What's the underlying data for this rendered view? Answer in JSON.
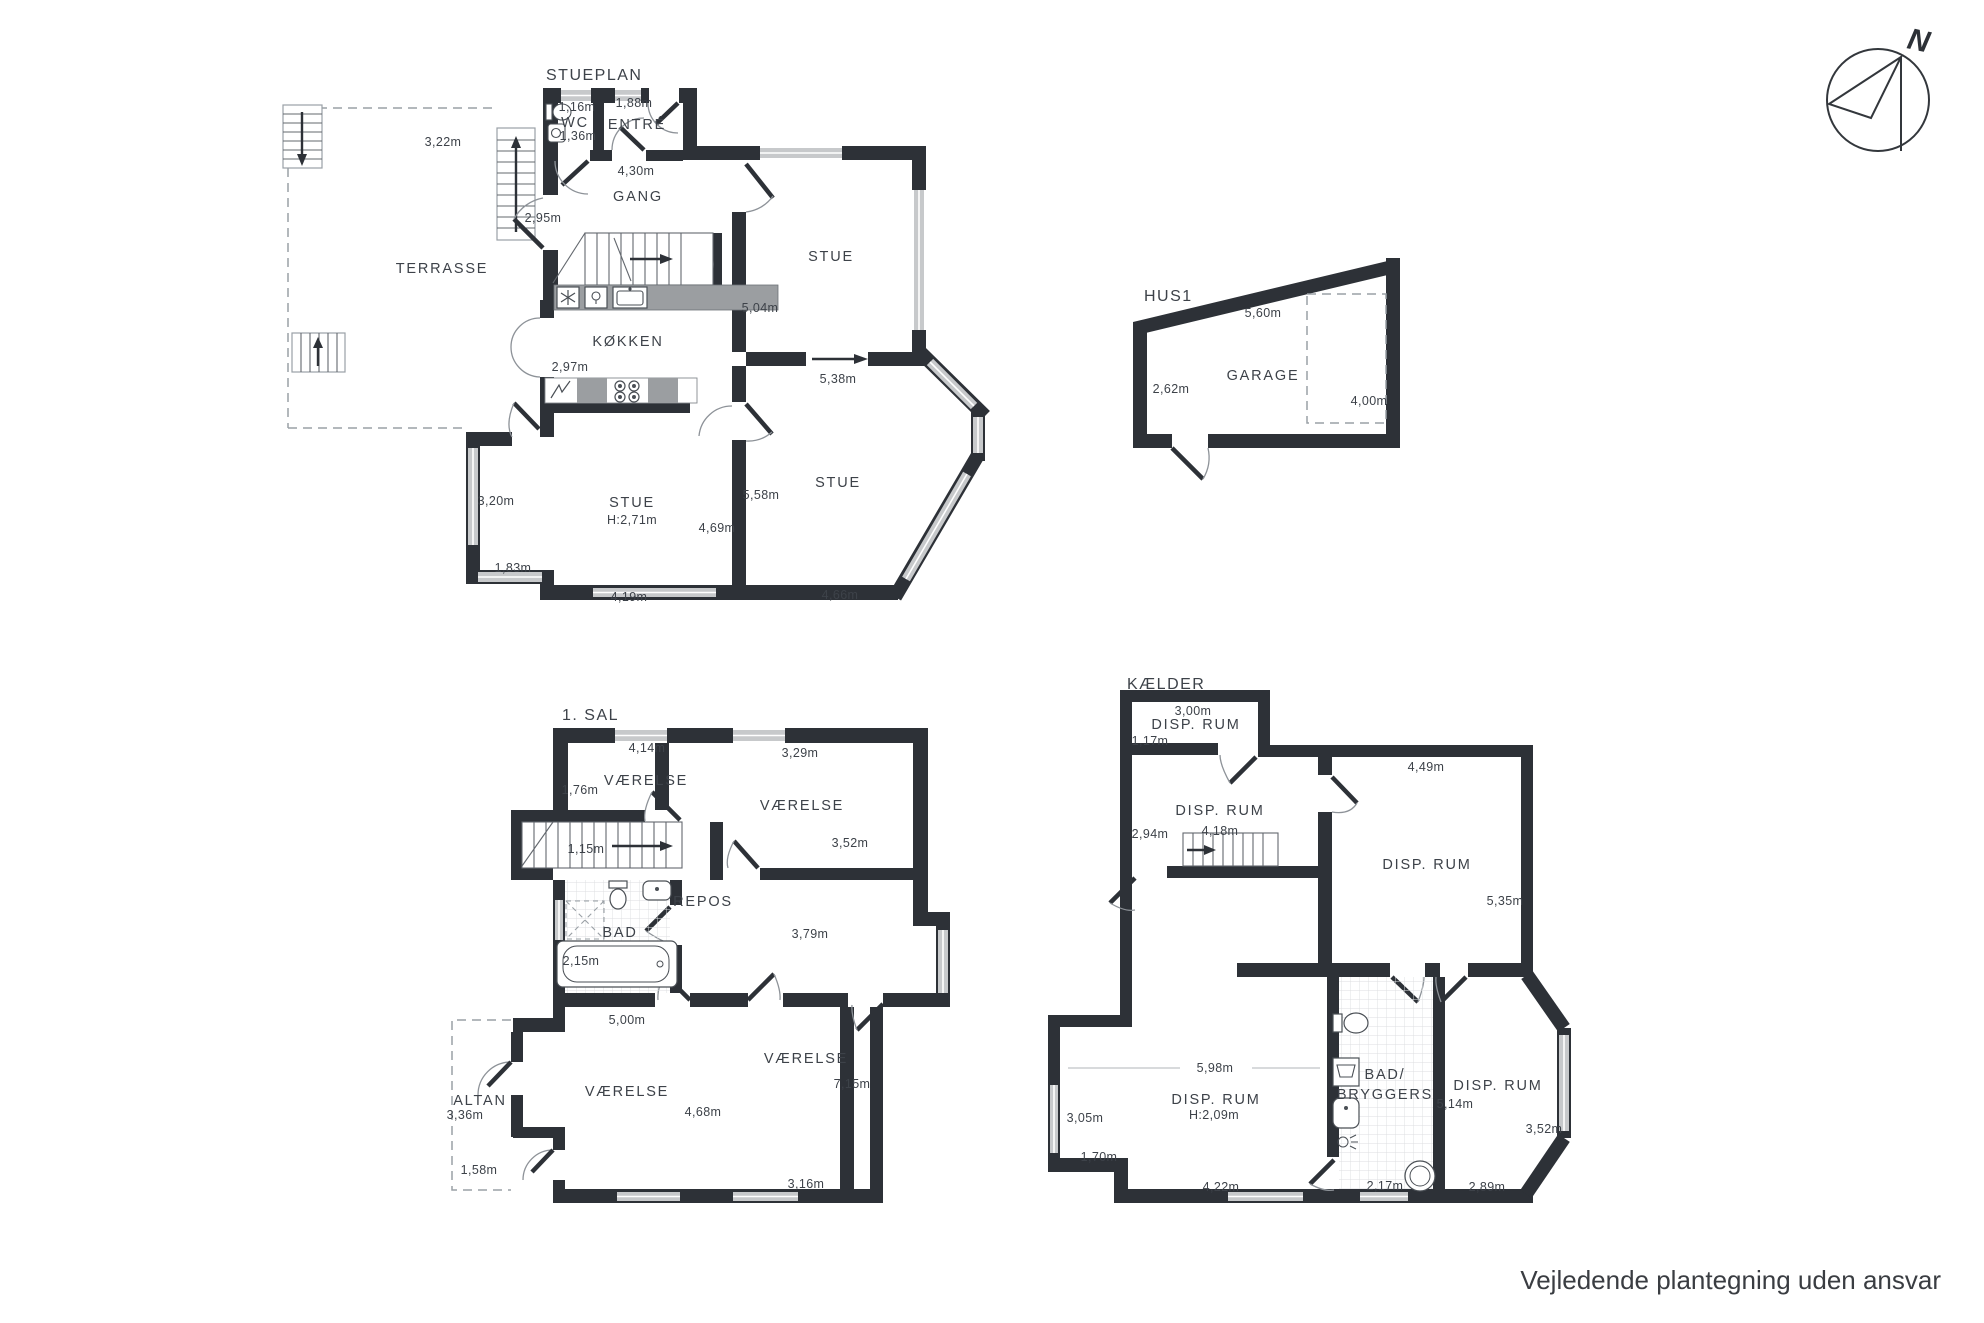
{
  "page": {
    "footer_note": "Vejledende plantegning uden ansvar"
  },
  "compass": {
    "north": "N"
  },
  "stueplan": {
    "title": "STUEPLAN",
    "rooms": {
      "terrasse": "TERRASSE",
      "wc": "WC",
      "entre": "ENTRÉ",
      "gang": "GANG",
      "kokken": "KØKKEN",
      "stue_top_right": "STUE",
      "stue_bottom_right": "STUE",
      "stue_bottom_left": "STUE",
      "stue_bottom_left_height": "H:2,71m"
    },
    "dims": {
      "wc_width": "1,16m",
      "wc_depth": "1,36m",
      "entre_width": "1,88m",
      "gang_width": "4,30m",
      "gang_side": "2,95m",
      "terrasse_width": "3,22m",
      "stue_tr_depth": "5,04m",
      "kokken_side": "2,97m",
      "stue_tr_width": "5,38m",
      "stue_bl_window": "3,20m",
      "stue_br_depth": "5,58m",
      "stue_bl_depth": "4,69m",
      "stue_bl_window2": "1,83m",
      "stue_bl_width": "4,19m",
      "stue_br_width": "4,66m"
    }
  },
  "hus1": {
    "title": "HUS1",
    "rooms": {
      "garage": "GARAGE"
    },
    "dims": {
      "top": "5,60m",
      "left": "2,62m",
      "right": "4,00m"
    }
  },
  "sal1": {
    "title": "1. SAL",
    "rooms": {
      "vaerelse_tl": "VÆRELSE",
      "vaerelse_tr": "VÆRELSE",
      "vaerelse_bl": "VÆRELSE",
      "vaerelse_br": "VÆRELSE",
      "bad": "BAD",
      "repos": "REPOS",
      "altan": "ALTAN"
    },
    "dims": {
      "tl_width": "4,14m",
      "tl_side": "1,76m",
      "tr_width": "3,29m",
      "tr_depth": "3,52m",
      "stairs": "1,15m",
      "bad_width": "2,15m",
      "mid_depth": "3,79m",
      "bl_width": "5,00m",
      "bl_depth": "4,68m",
      "br_depth": "7,15m",
      "br_width": "3,16m",
      "altan_width": "3,36m",
      "altan_side": "1,58m"
    }
  },
  "kaelder": {
    "title": "KÆLDER",
    "rooms": {
      "disp_tl": "DISP. RUM",
      "disp_mid": "DISP. RUM",
      "disp_right": "DISP. RUM",
      "disp_bl": "DISP. RUM",
      "disp_bl_height": "H:2,09m",
      "disp_br": "DISP. RUM",
      "bad_line1": "BAD/",
      "bad_line2": "BRYGGERS"
    },
    "dims": {
      "tl_width": "3,00m",
      "tl_side": "1,17m",
      "right_width": "4,49m",
      "mid_side": "2,94m",
      "stairs": "4,18m",
      "right_depth": "5,35m",
      "bl_width": "5,98m",
      "bl_window": "3,05m",
      "bl_window2": "1,70m",
      "bl_width2": "4,22m",
      "bad_width": "2,17m",
      "br_depth": "5,14m",
      "br_window": "3,52m",
      "br_width": "2,89m"
    }
  }
}
